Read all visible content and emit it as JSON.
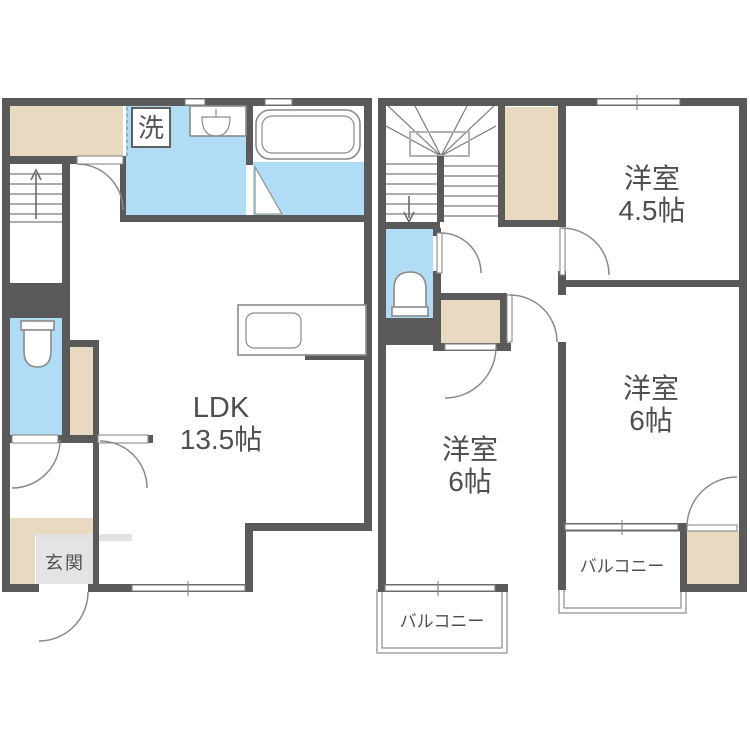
{
  "plan": {
    "type": "floorplan",
    "colors": {
      "wall": "#5a5a5a",
      "wet_area": "#b0dcf5",
      "closet": "#e9d9c1",
      "genkan_floor": "#e4e4e6",
      "line": "#8a8a8a",
      "text": "#4f4f4f",
      "background": "#ffffff"
    },
    "icons": [
      "bathtub-icon",
      "washbasin-icon",
      "toilet-icon",
      "stairs-up-arrow",
      "stairs-down-arrow"
    ]
  },
  "rooms": {
    "ldk": {
      "label": "LDK",
      "size": "13.5帖"
    },
    "genkan": {
      "label": "玄関"
    },
    "laundry": {
      "label": "洗"
    },
    "western_45": {
      "label": "洋室",
      "size": "4.5帖"
    },
    "western_6_right": {
      "label": "洋室",
      "size": "6帖"
    },
    "western_6_bottom": {
      "label": "洋室",
      "size": "6帖"
    },
    "balcony_right": {
      "label": "バルコニー"
    },
    "balcony_bottom": {
      "label": "バルコニー"
    }
  }
}
